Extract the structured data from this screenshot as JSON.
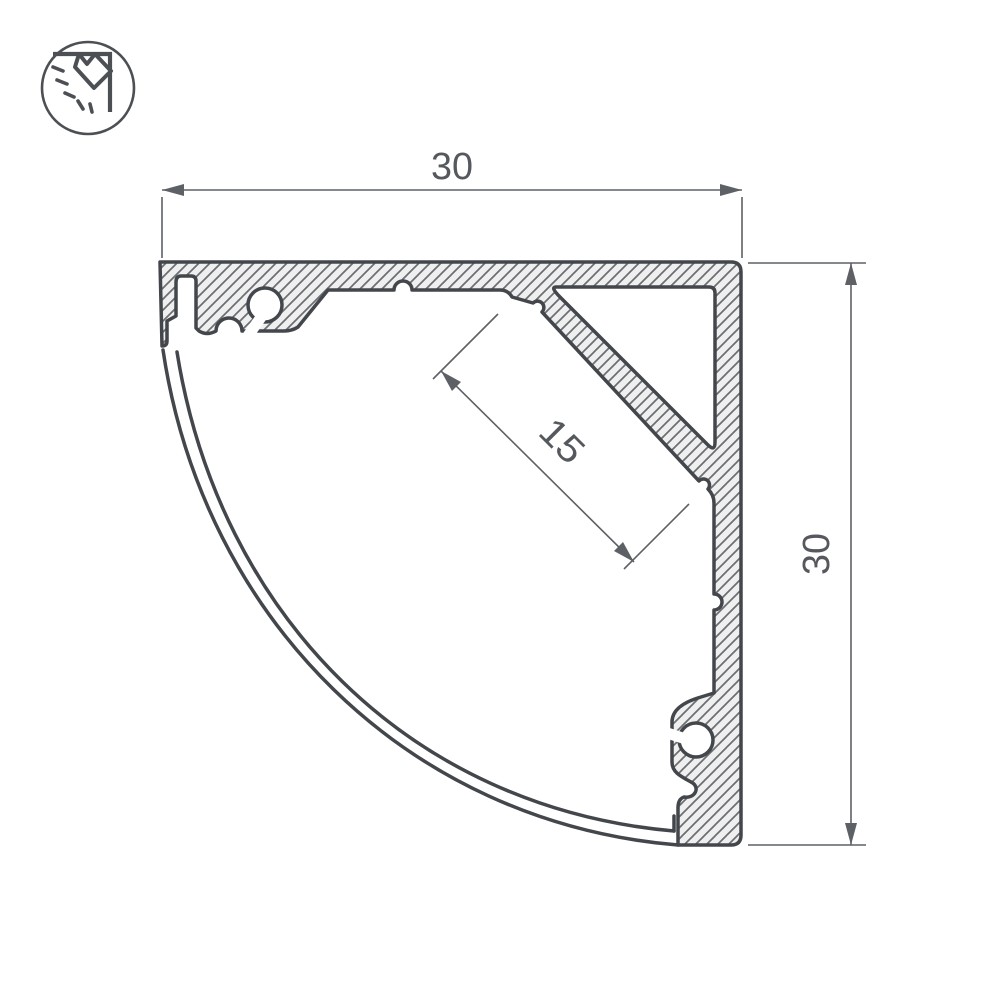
{
  "drawing": {
    "title": "LED corner aluminium profile cross-section drawing",
    "dim_width": "30",
    "dim_height": "30",
    "dim_led_surface": "15"
  },
  "logo": {
    "icon": "corner-light-icon"
  },
  "colors": {
    "background": "#ffffff",
    "outline": "#43474b",
    "hatch_line": "#6a6e72",
    "aluminum_fill": "#efefef",
    "dimension_line": "#5d6166",
    "text": "#55595d",
    "logo_stroke": "#4c5054"
  }
}
